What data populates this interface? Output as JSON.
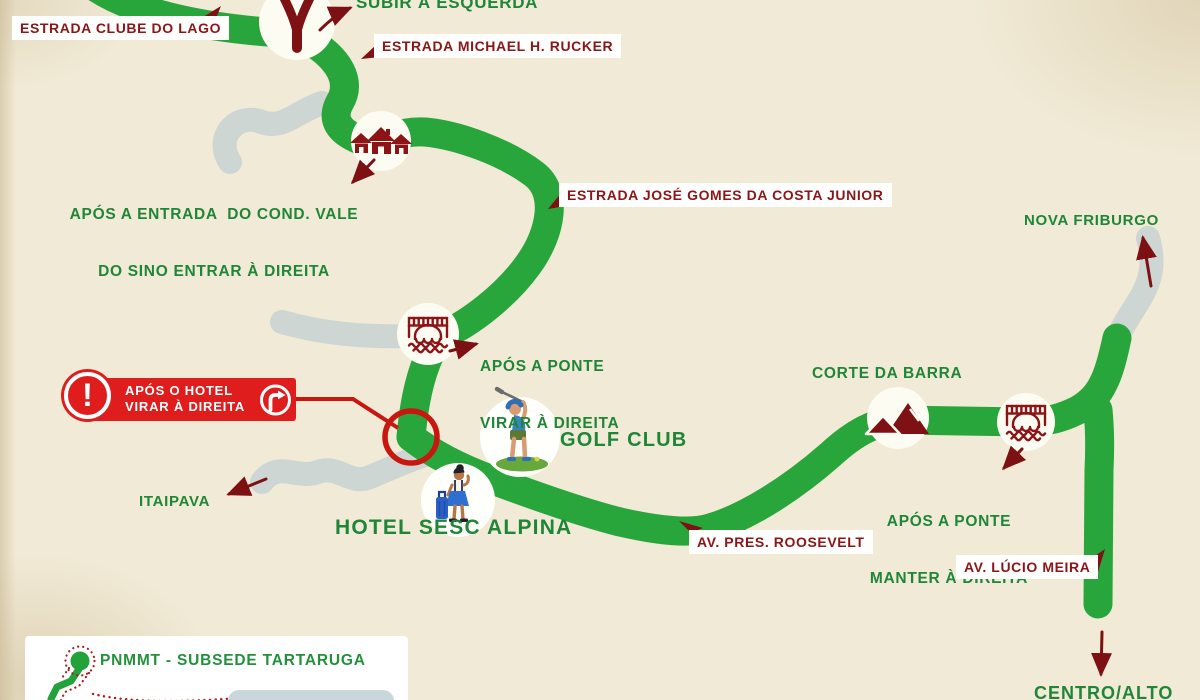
{
  "colors": {
    "background": "#f1ead6",
    "road_primary_green": "#29a63b",
    "road_secondary_gray": "#cdd6d2",
    "text_green": "#1f8637",
    "text_dark_red": "#8b1518",
    "arrow_dark_red": "#7d1013",
    "alert_red": "#e01d1d",
    "highlight_ring_red": "#c8170f"
  },
  "roads": {
    "estrada_clube_do_lago": "ESTRADA CLUBE DO LAGO",
    "estrada_michael_rucker": "ESTRADA MICHAEL H. RUCKER",
    "estrada_jose_gomes": "ESTRADA JOSÉ GOMES DA COSTA JUNIOR",
    "av_pres_roosevelt": "AV. PRES. ROOSEVELT",
    "av_lucio_meira": "AV. LÚCIO MEIRA"
  },
  "directions": {
    "subir_esquerda": "SUBIR À ESQUERDA",
    "apos_entrada_1": "APÓS A ENTRADA  DO COND. VALE",
    "apos_entrada_2": "DO SINO ENTRAR À DIREITA",
    "apos_ponte_virar_1": "APÓS A PONTE",
    "apos_ponte_virar_2": "VIRAR À DIREITA",
    "apos_ponte_manter_1": "APÓS A PONTE",
    "apos_ponte_manter_2": "MANTER À DIREITA"
  },
  "alert": {
    "line1": "APÓS O HOTEL",
    "line2": "VIRAR À DIREITA",
    "exclamation": "!"
  },
  "places": {
    "nova_friburgo": "NOVA FRIBURGO",
    "corte_da_barra": "CORTE DA BARRA",
    "golf_club": "GOLF CLUB",
    "hotel_sesc_alpina": "HOTEL SESC ALPINA",
    "itaipava": "ITAIPAVA",
    "centro_alto": "CENTRO/ALTO"
  },
  "legend": {
    "title": "PNMMT - SUBSEDE TARTARUGA"
  },
  "icons": {
    "junction": "road-fork-icon",
    "houses": "condominium-houses-icon",
    "bridge": "bridge-icon",
    "golfer": "golfer-icon",
    "traveler": "hotel-guest-icon",
    "mountain": "mountain-icon",
    "map_pin": "map-pin-icon",
    "exclamation": "exclamation-icon",
    "turn_right": "turn-right-icon"
  }
}
